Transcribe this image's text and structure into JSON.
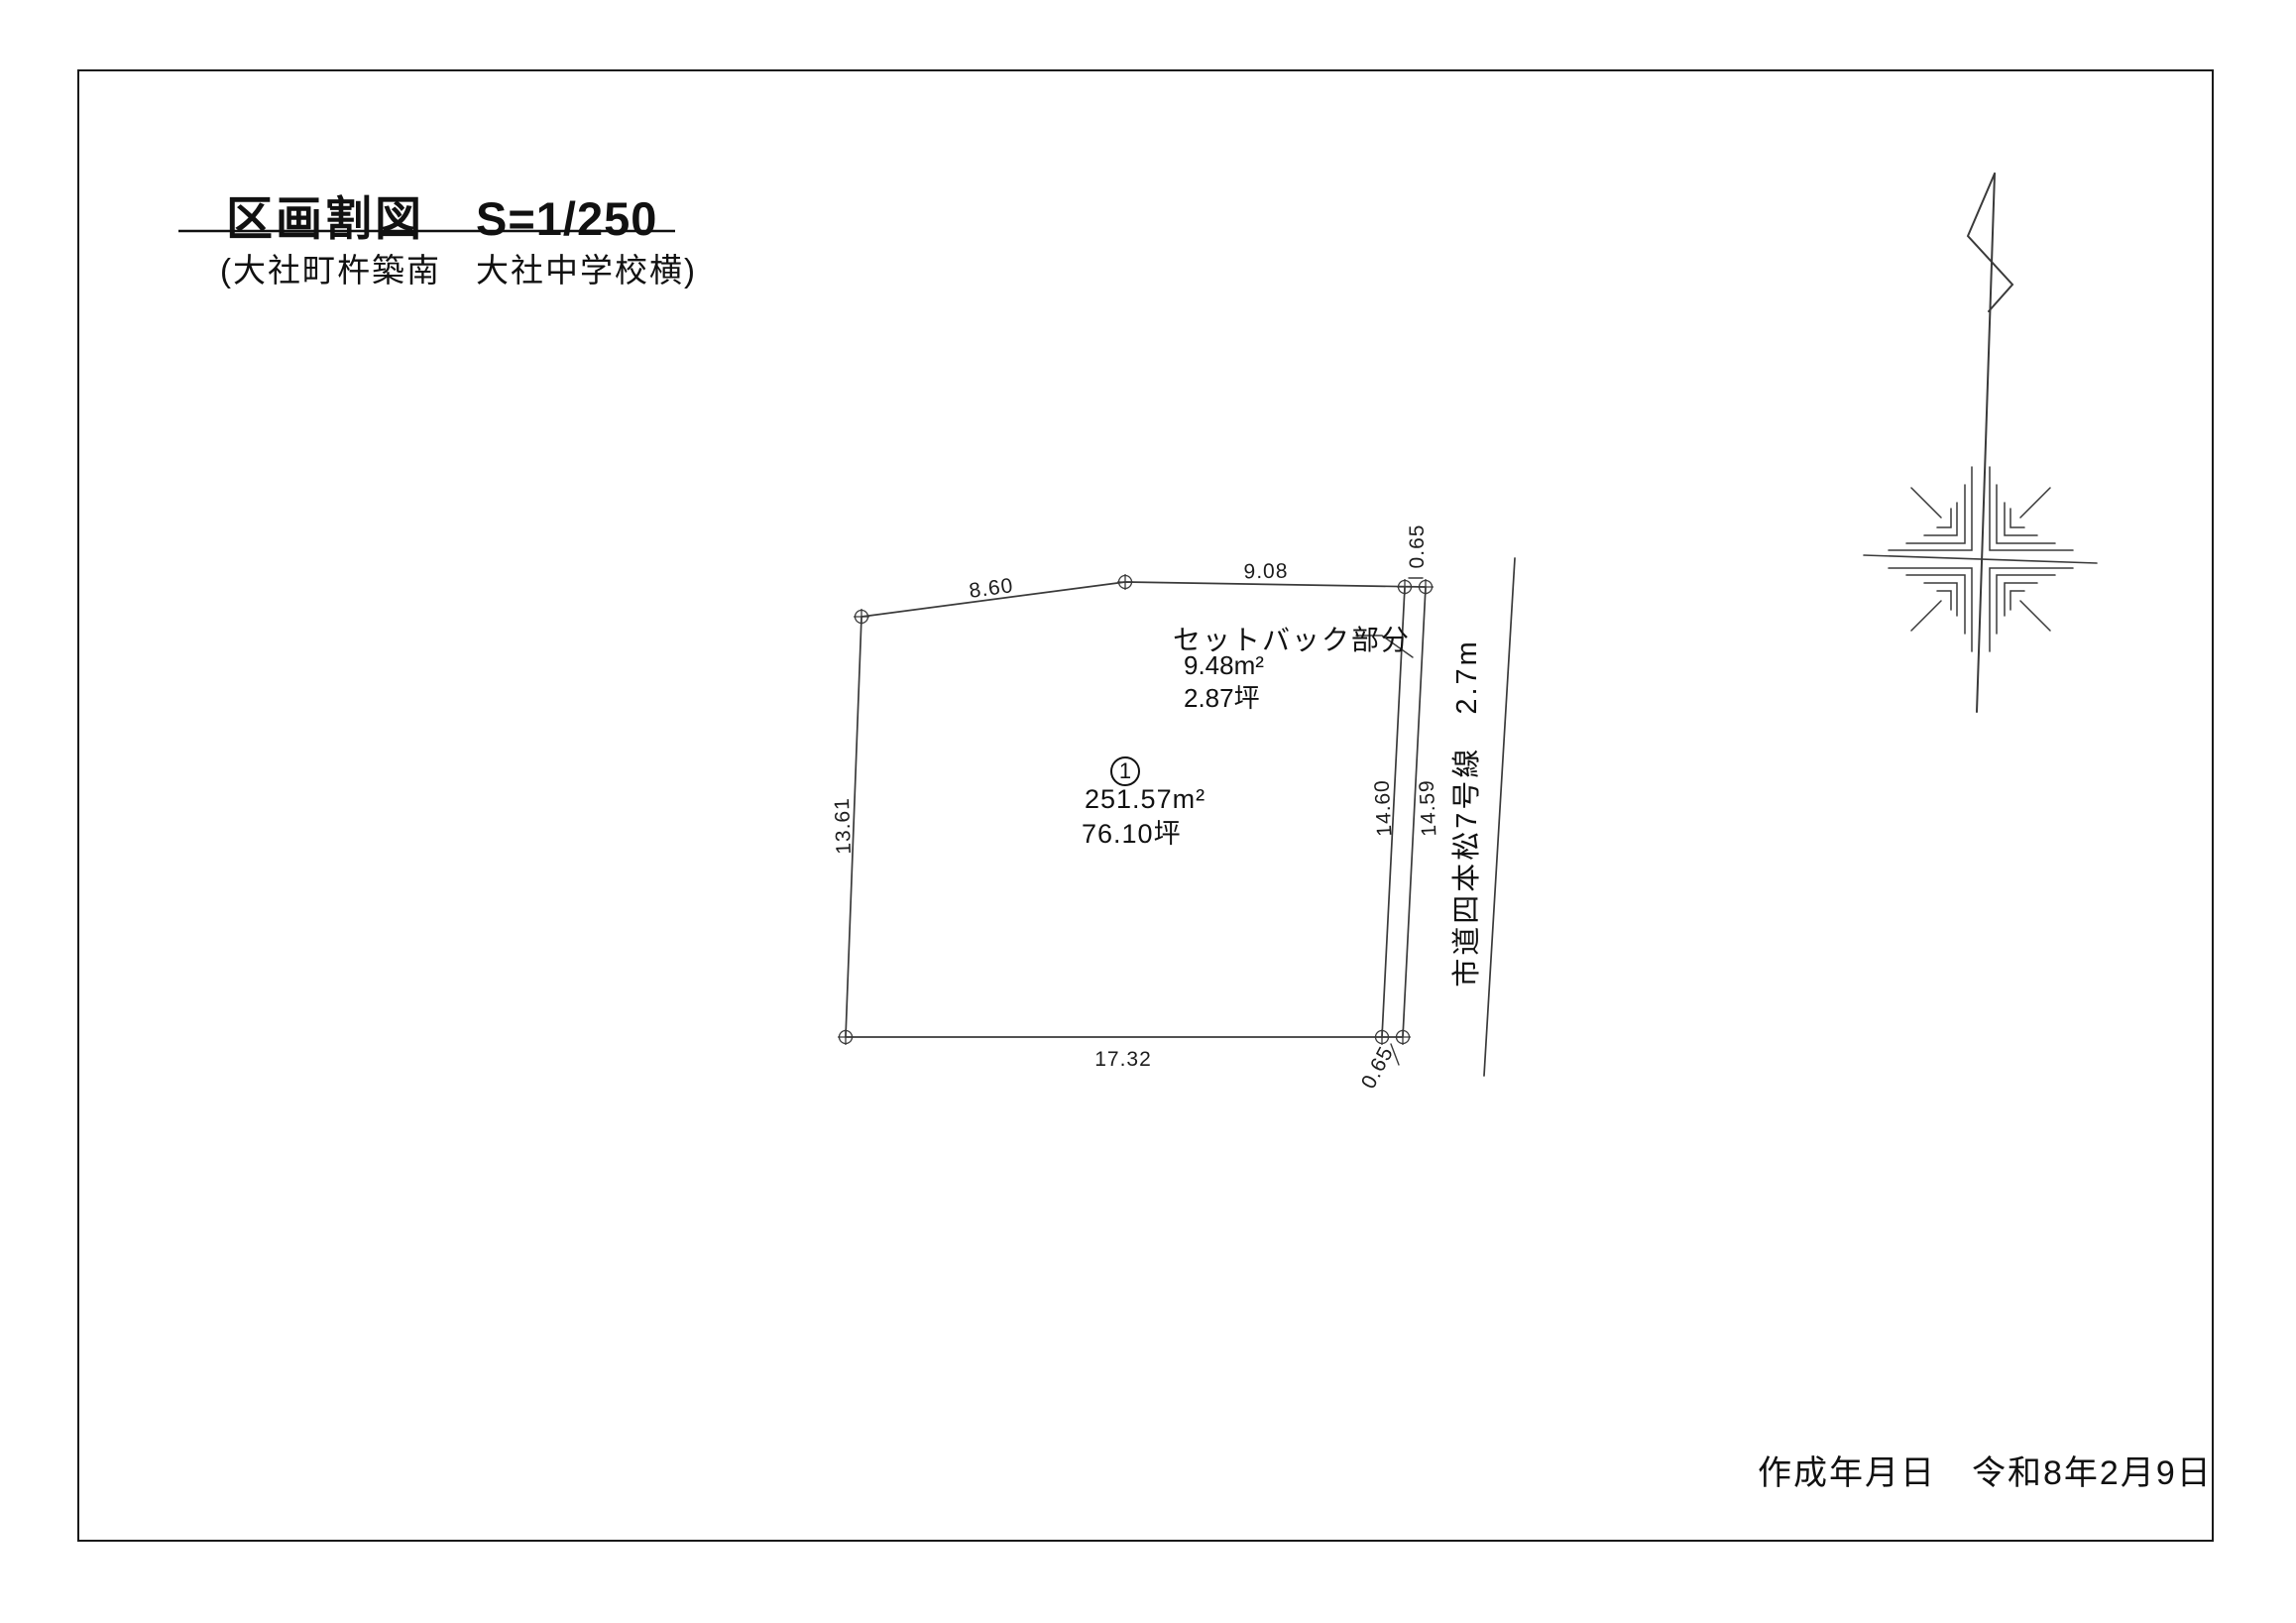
{
  "drawing": {
    "title": "区画割図",
    "scale": "S=1/250",
    "subtitle": "(大社町杵築南　大社中学校横)"
  },
  "parcel": {
    "number": "1",
    "area_sqm": "251.57m²",
    "area_tsubo": "76.10坪"
  },
  "setback": {
    "label": "セットバック部分",
    "area_sqm": "9.48m²",
    "area_tsubo": "2.87坪"
  },
  "road": {
    "label": "市道四本松7号線　2.7m"
  },
  "dimensions": {
    "top_left_edge": "8.60",
    "top_right_edge": "9.08",
    "left_edge": "13.61",
    "bottom_edge": "17.32",
    "right_edge_inner": "14.60",
    "right_edge_outer": "14.59",
    "setback_width_top": "0.65",
    "setback_width_bottom": "0.65"
  },
  "footer": {
    "label": "作成年月日",
    "date": "令和8年2月9日"
  }
}
